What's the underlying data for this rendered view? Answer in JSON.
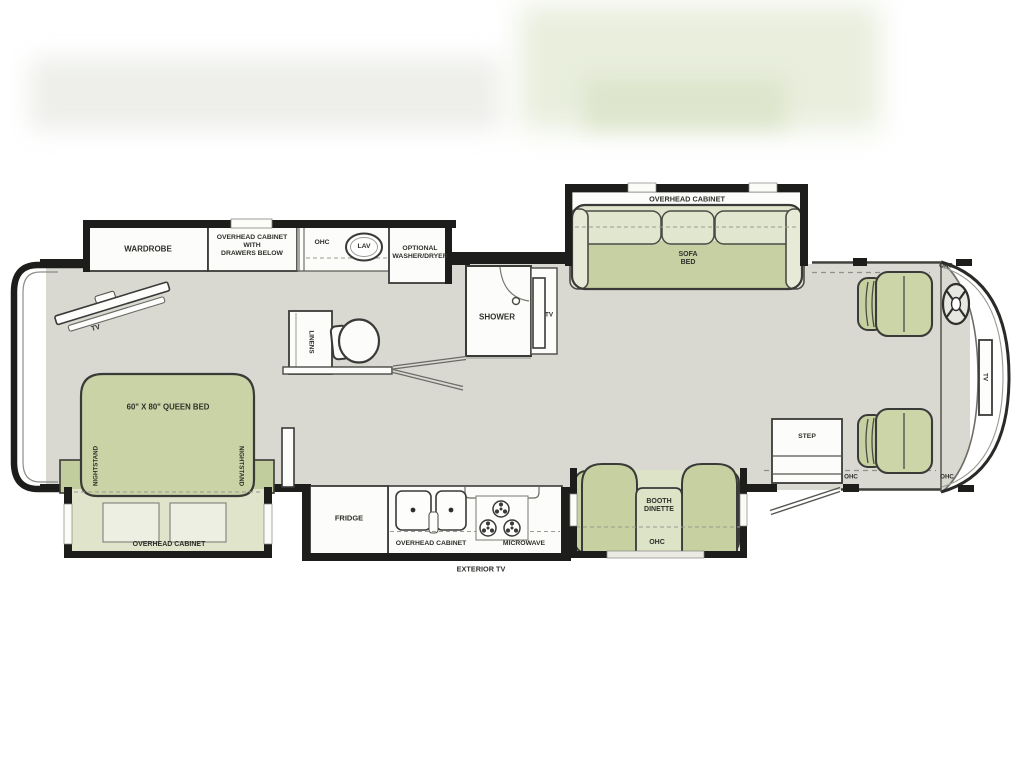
{
  "palette": {
    "floor": "#d9d8d1",
    "wall": "#1d1d1b",
    "furniture_green": "#c6d0a1",
    "furniture_green_light": "#dfe4ca",
    "cabinet_white": "#fcfcfa",
    "label_color": "#2f2f2b"
  },
  "floorplan": {
    "bedroom": {
      "wardrobe": "WARDROBE",
      "overhead_cabinet_drawers": "OVERHEAD CABINET\nWITH\nDRAWERS BELOW",
      "tv": "TV",
      "queen_bed": "60\" X 80\" QUEEN BED",
      "nightstand_left": "NIGHTSTAND",
      "nightstand_right": "NIGHTSTAND",
      "overhead_cabinet": "OVERHEAD CABINET"
    },
    "bath": {
      "ohc": "OHC",
      "lav": "LAV",
      "washer_dryer": "OPTIONAL\nWASHER/DRYER",
      "linens": "LINENS",
      "shower": "SHOWER",
      "tv": "TV"
    },
    "kitchen": {
      "fridge": "FRIDGE",
      "overhead_cabinet": "OVERHEAD CABINET",
      "microwave": "MICROWAVE",
      "exterior_tv": "EXTERIOR TV"
    },
    "living": {
      "sofa_overhead_cabinet": "OVERHEAD CABINET",
      "sofa_bed": "SOFA\nBED",
      "booth_dinette": "BOOTH\nDINETTE",
      "booth_ohc": "OHC"
    },
    "cab": {
      "step": "STEP",
      "ohc_top": "OHC",
      "ohc_entry_left": "OHC",
      "ohc_entry_right": "OHC",
      "tv": "TV"
    }
  }
}
